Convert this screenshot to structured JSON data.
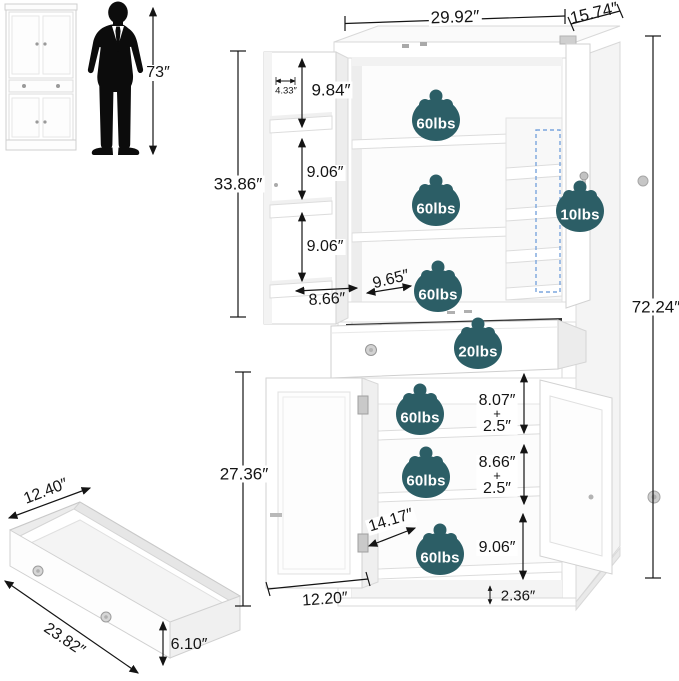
{
  "colors": {
    "badge_fill": "#2c5e66",
    "badge_text": "#ffffff",
    "dimension": "#141414",
    "dashed_highlight": "#7ba6dd"
  },
  "scale_reference": {
    "person_height_label": "73″"
  },
  "main_cabinet": {
    "width_label": "29.92″",
    "depth_label": "15.74″",
    "overall_height_label": "72.24″",
    "upper": {
      "interior_height_label": "33.86″",
      "door_tray_depth_label": "4.33″",
      "tray_gap_labels": [
        "9.84″",
        "9.06″",
        "9.06″"
      ],
      "door_width_label": "8.66″",
      "shelf_depth_label": "9.65″",
      "shelf_capacity_labels": [
        "60lbs",
        "60lbs",
        "60lbs"
      ],
      "door_rack_capacity_label": "10lbs"
    },
    "drawer": {
      "capacity_label": "20lbs"
    },
    "lower": {
      "interior_height_label": "27.36″",
      "gap1": {
        "value": "8.07″",
        "plus": "+",
        "adjust": "2.5″"
      },
      "gap2": {
        "value": "8.66″",
        "plus": "+",
        "adjust": "2.5″"
      },
      "gap3": "9.06″",
      "base_height_label": "2.36″",
      "shelf_depth_label": "14.17″",
      "door_width_label": "12.20″",
      "shelf_capacity_labels": [
        "60lbs",
        "60lbs",
        "60lbs"
      ]
    }
  },
  "rolling_drawer": {
    "width_label": "12.40″",
    "length_label": "23.82″",
    "height_label": "6.10″"
  }
}
